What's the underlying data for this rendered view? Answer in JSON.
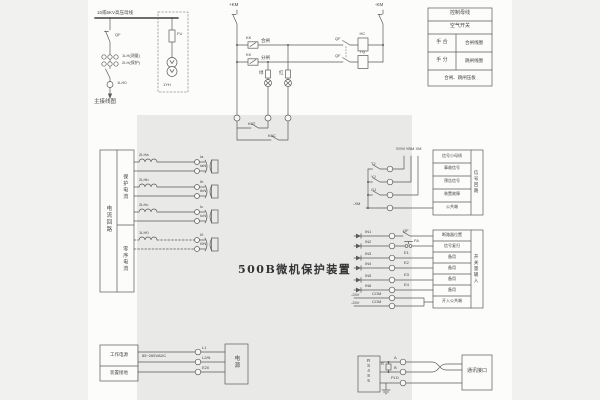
{
  "title": "500B微机保护装置",
  "colors": {
    "margin": "#f1f1f0",
    "page": "#fcfcfb",
    "panel": "#e9e9e8",
    "line": "#5a5a5a",
    "text": "#454545"
  },
  "main_diagram": {
    "busbar": "10或6KV高压母线",
    "breaker": "QF",
    "ct_measure": "1LH(测量)",
    "ct_protect": "2LH(保护)",
    "ct_zero": "1LH0",
    "fuse": "FU",
    "pt": "1YH",
    "caption": "主接线图"
  },
  "control": {
    "bus_pos": "+KM",
    "bus_neg": "-KM",
    "kk1": "KK",
    "kk2": "KK",
    "close": "合闸",
    "trip": "分闸",
    "qf1": "QF",
    "qf2": "QF",
    "close_coil": "HC",
    "trip_coil": "TQ",
    "green_lamp": "绿",
    "red_lamp": "红",
    "k0t": "K0T",
    "k0c": "K0C"
  },
  "legend": {
    "rows": [
      "控制母线",
      "空气开关"
    ],
    "pairs": [
      {
        "left": "手  合",
        "right": "合闸线圈"
      },
      {
        "left": "手  分",
        "right": "跳闸线圈"
      }
    ],
    "footer": "合闸、跳闸压板"
  },
  "current": {
    "side": "电流回路",
    "cell_protect": "保护电流",
    "cell_zero": "零序电流",
    "windings": [
      "2LHa",
      "2LHb",
      "2LHc",
      "1LH0"
    ],
    "terminals": [
      "Ia",
      "IaN",
      "Ib",
      "IbN",
      "Ic",
      "IcN",
      "I0",
      "I0N"
    ]
  },
  "signal": {
    "buses": "SYM YBM XM",
    "contacts": [
      "TJ",
      "YJ",
      "GJ"
    ],
    "common": "-XM",
    "rows": [
      "信号小母线",
      "事故信号",
      "预告信号",
      "装置故障",
      "公共端"
    ],
    "side": "信号回路"
  },
  "binary": {
    "inputs": [
      "IN1",
      "IN2",
      "IN3",
      "IN4",
      "IN5",
      "IN6"
    ],
    "com_label": "-24V",
    "com": "COM",
    "qf": "QF",
    "reset_btn": "FA",
    "spare_wires": [
      "E1",
      "E2",
      "E3",
      "E4"
    ],
    "rows": [
      "断路器位置",
      "信号复归",
      "备用",
      "备用",
      "备用",
      "备用",
      "开入公共端"
    ],
    "side": "开关量输入"
  },
  "power": {
    "cells": [
      "工作电源",
      "装置接地"
    ],
    "range": "85~265VADC",
    "terminals": [
      "L1",
      "L2/N",
      "E20"
    ],
    "box": "电源"
  },
  "comm": {
    "device": "RS485",
    "a": "A",
    "b": "B",
    "r": "R",
    "shield": "PLD",
    "box": "通讯接口"
  }
}
